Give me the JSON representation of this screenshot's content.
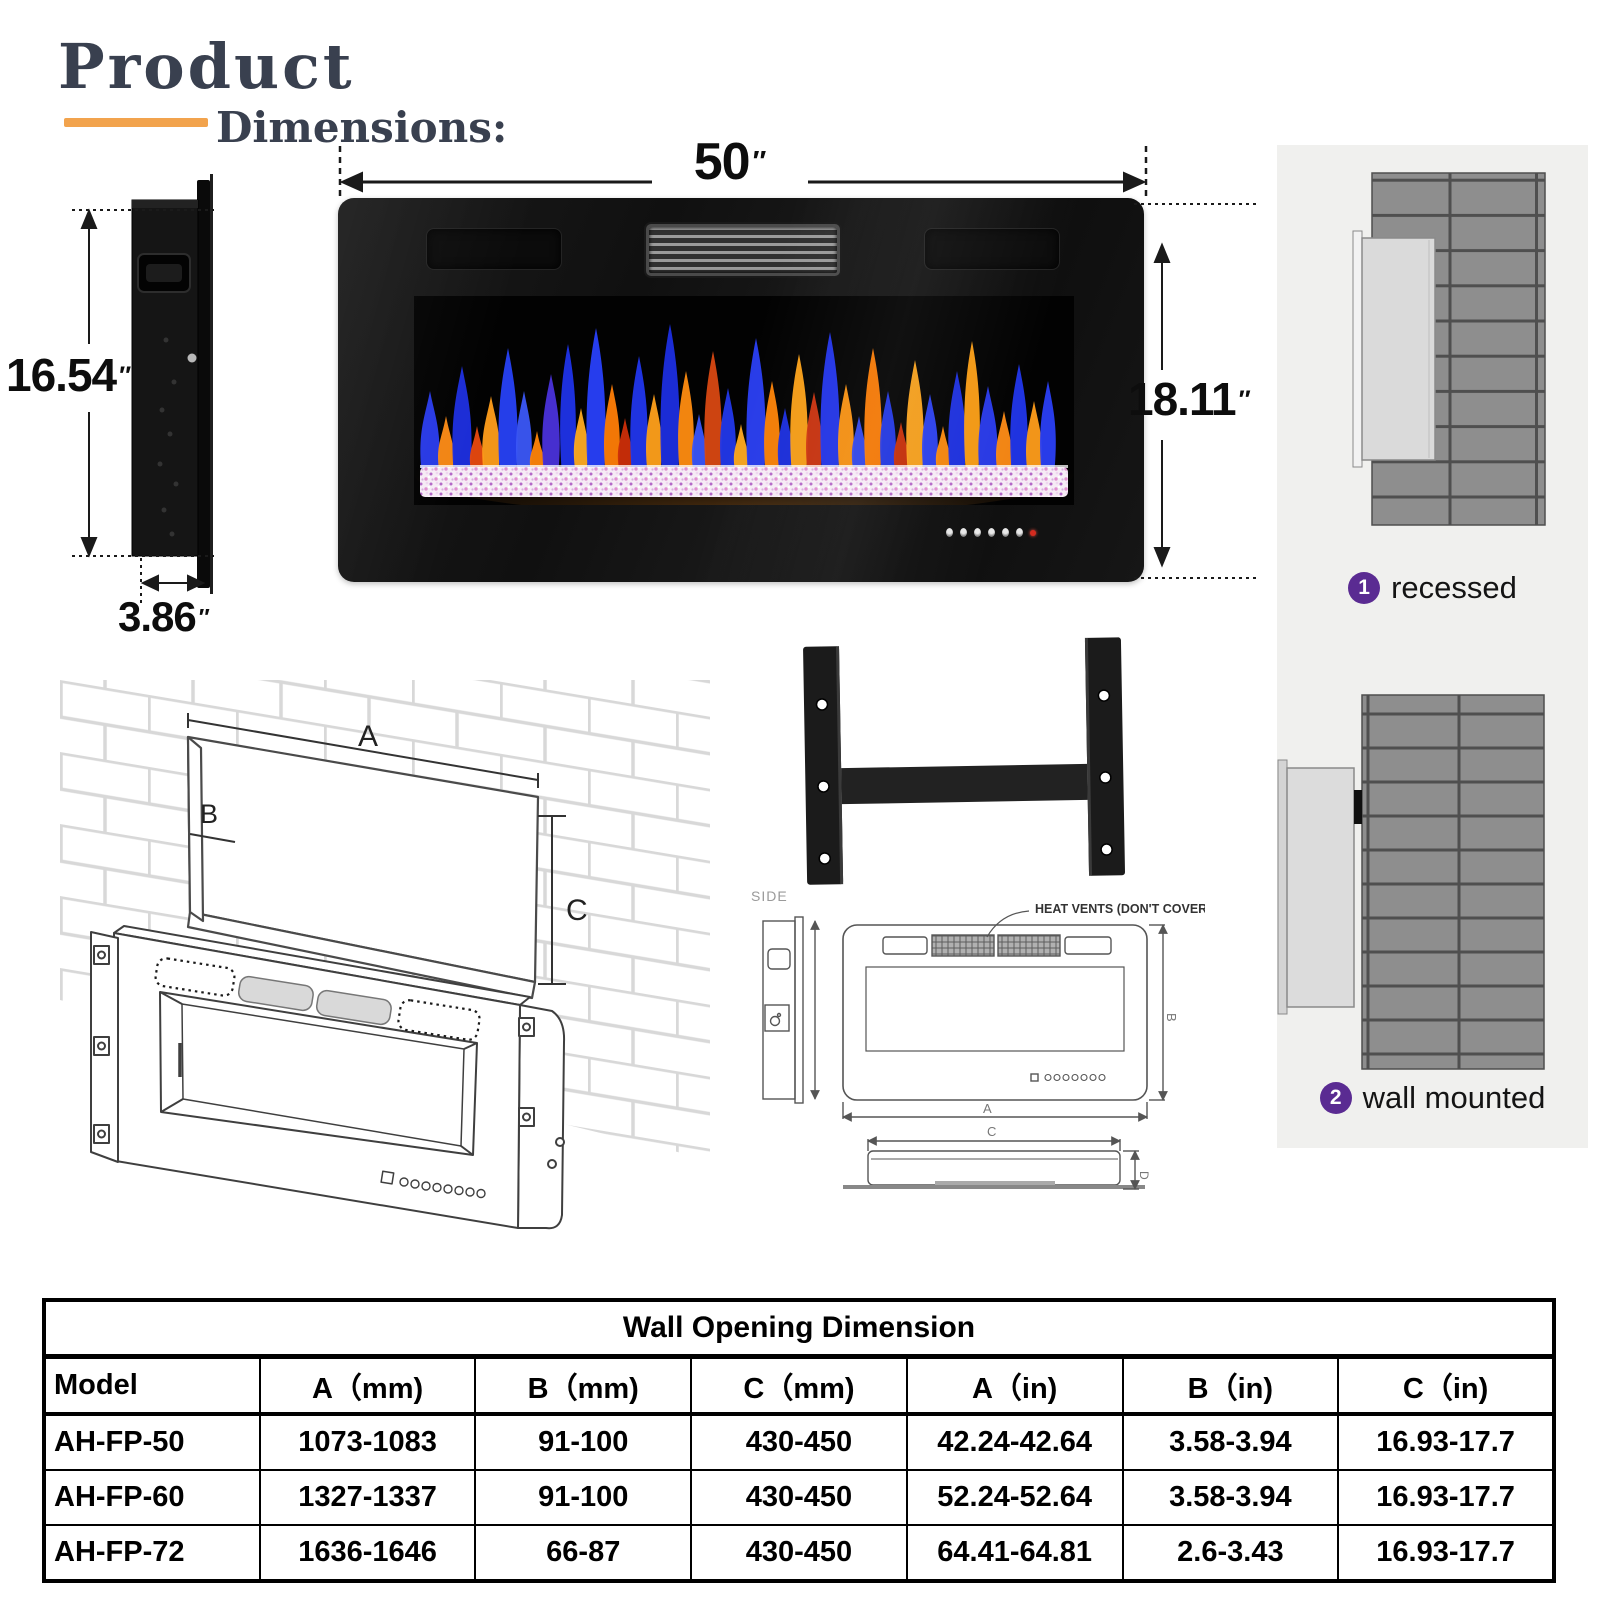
{
  "header": {
    "title": "Product",
    "subtitle": "Dimensions:"
  },
  "colors": {
    "accent_underline": "#f2a34d",
    "title_text": "#39404f",
    "badge": "#5a2b92",
    "panel_bg": "#f0f0ee",
    "power_led": "#d42b1f",
    "flame_blue": "#2238ea",
    "flame_orange": "#ff8c15"
  },
  "dimensions": {
    "side_height": "16.54",
    "side_depth": "3.86",
    "front_width": "50",
    "front_height": "18.11",
    "inch": "″"
  },
  "installation": {
    "options": [
      {
        "number": "1",
        "label": "recessed"
      },
      {
        "number": "2",
        "label": "wall mounted"
      }
    ]
  },
  "opening_diagram": {
    "label_a": "A",
    "label_b": "B",
    "label_c": "C"
  },
  "tech_drawing": {
    "side_label": "SIDE",
    "vent_note": "HEAT VENTS (DON'T COVER)  SIDE",
    "dim_a": "A",
    "dim_b": "B",
    "dim_c": "C",
    "dim_d": "D"
  },
  "table": {
    "title": "Wall Opening Dimension",
    "columns": [
      "Model",
      "A（mm)",
      "B（mm)",
      "C（mm)",
      "A（in)",
      "B（in)",
      "C（in)"
    ],
    "rows": [
      [
        "AH-FP-50",
        "1073-1083",
        "91-100",
        "430-450",
        "42.24-42.64",
        "3.58-3.94",
        "16.93-17.7"
      ],
      [
        "AH-FP-60",
        "1327-1337",
        "91-100",
        "430-450",
        "52.24-52.64",
        "3.58-3.94",
        "16.93-17.7"
      ],
      [
        "AH-FP-72",
        "1636-1646",
        "66-87",
        "430-450",
        "64.41-64.81",
        "2.6-3.43",
        "16.93-17.7"
      ]
    ]
  }
}
